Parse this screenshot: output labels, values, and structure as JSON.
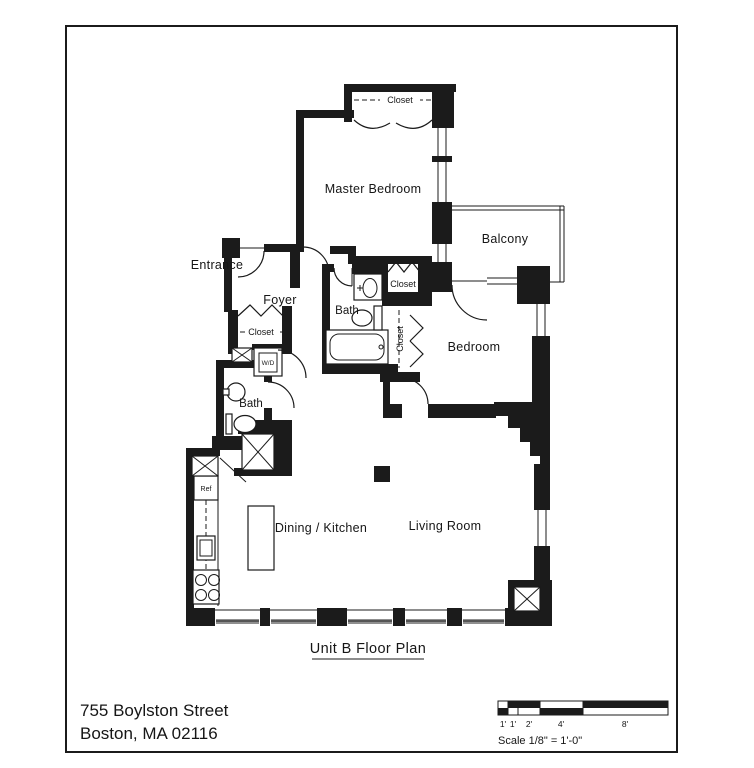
{
  "header": {
    "title": "Unit B Floor Plan"
  },
  "footer": {
    "address_line1": "755 Boylston Street",
    "address_line2": "Boston, MA 02116"
  },
  "rooms": {
    "master_bedroom": "Master Bedroom",
    "balcony": "Balcony",
    "bedroom": "Bedroom",
    "entrance": "Entrance",
    "foyer": "Foyer",
    "master_bath": "Bath",
    "hall_bath": "Bath",
    "dining_kitchen": "Dining / Kitchen",
    "living_room": "Living Room"
  },
  "closets": {
    "master_closet": "Closet",
    "hall_closet": "Closet",
    "bedroom_closet": "Closet",
    "foyer_closet": "Closet"
  },
  "appliances": {
    "washer_dryer": "W/D",
    "refrigerator": "Ref"
  },
  "scale_bar": {
    "ticks": [
      "1'",
      "1'",
      "2'",
      "4'",
      "8'"
    ],
    "label": "Scale  1/8\" = 1'-0\""
  },
  "colors": {
    "ink": "#1b1b1b",
    "paper": "#ffffff"
  }
}
